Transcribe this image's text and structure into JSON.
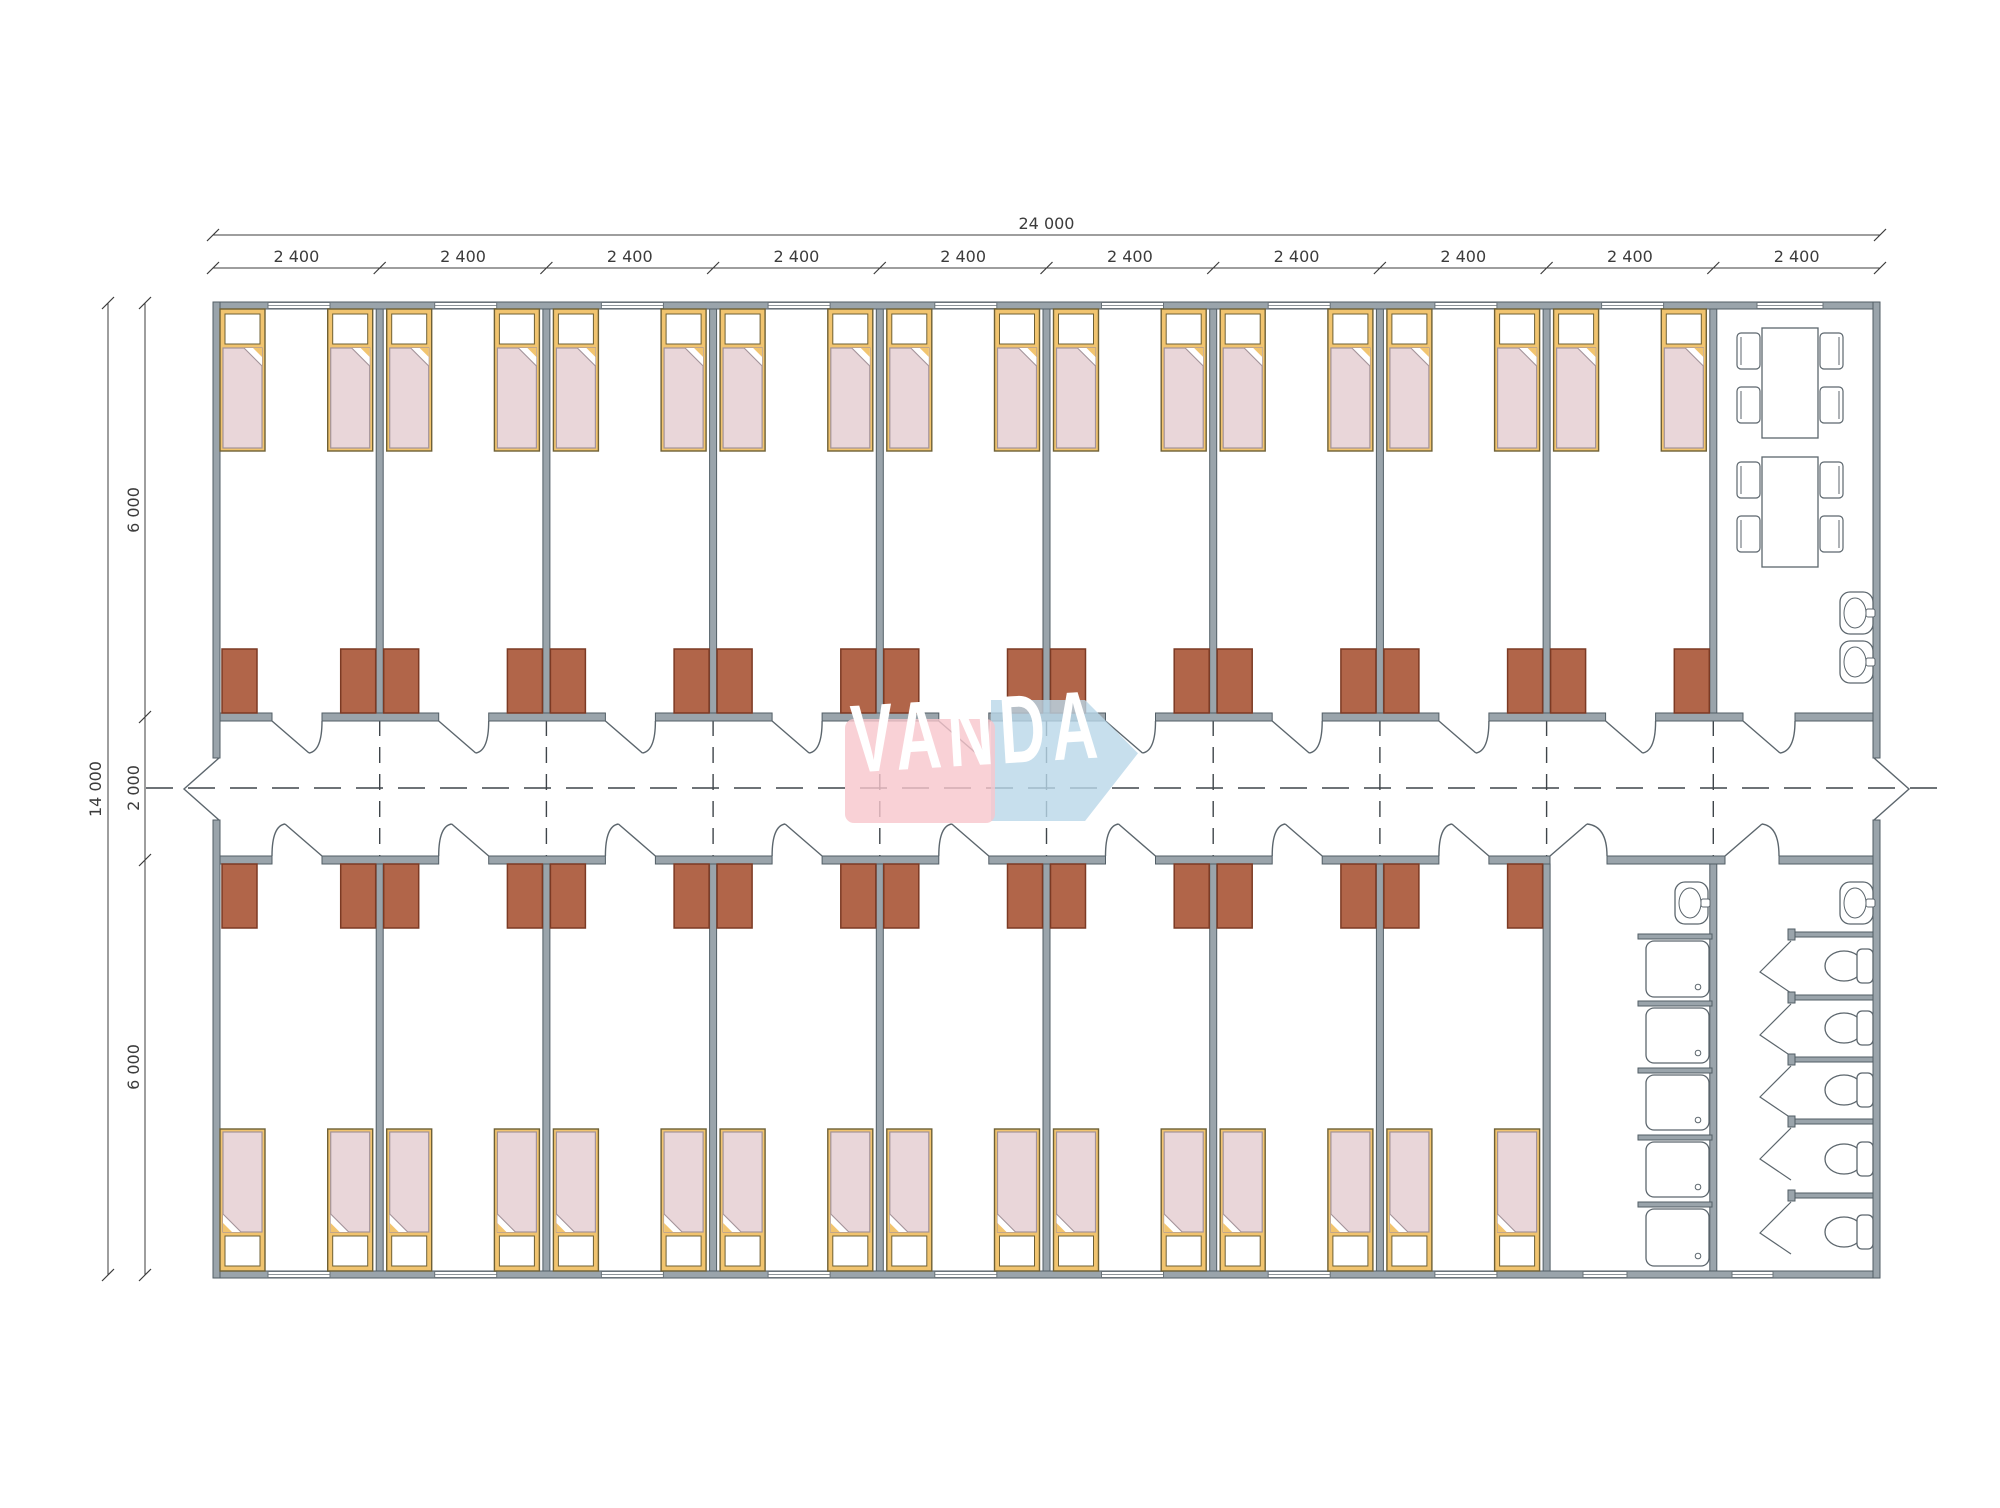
{
  "page": {
    "width": 2000,
    "height": 1508,
    "background": "#ffffff"
  },
  "logo": {
    "text": "VANDA",
    "pink_color": "#f8c6cc",
    "blue_color": "#b9d7e8",
    "text_color": "#ffffff"
  },
  "dimensions": {
    "total_width_label": "24 000",
    "module_width_label": "2 400",
    "module_count": 10,
    "total_height_label": "14 000",
    "height_segment_labels": [
      "6 000",
      "2 000",
      "6 000"
    ]
  },
  "plan": {
    "type": "container dormitory floor plan",
    "colors": {
      "wall_fill": "#9aa4ab",
      "wall_edge": "#525e66",
      "bed_frame": "#f1c46f",
      "bed_edge": "#6e6036",
      "bed_sheet": "#ffffff",
      "blanket": "#e9d6d9",
      "blanket_edge": "#a39399",
      "cabinet_fill": "#b16549",
      "cabinet_edge": "#7c3a24",
      "line": "#5c666d",
      "dash": "#3f454a",
      "dim": "#3c3c3c",
      "window_line": "#6a737a"
    },
    "modules": {
      "bedroom_top_count": 9,
      "bedroom_bottom_count": 8
    },
    "beds": {
      "top_row": 18,
      "bottom_row": 16
    },
    "wardrobes": {
      "top_row": 18,
      "bottom_row": 16
    },
    "dining": {
      "tables": 2,
      "chairs_per_table": 4
    },
    "sanitary": {
      "wash_basins": 4,
      "shower_trays": 5,
      "toilets": 5,
      "toilet_stalls": 5
    }
  }
}
